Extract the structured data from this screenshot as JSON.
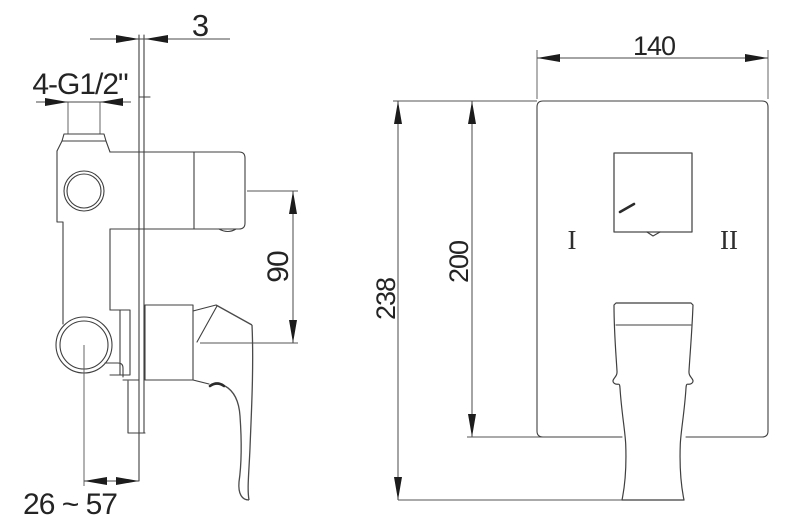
{
  "colors": {
    "background": "#ffffff",
    "line": "#3f3f3f",
    "dimension_line": "#4a4a4a",
    "arrow": "#1c1c1c",
    "text": "#242424"
  },
  "side_view": {
    "dims": {
      "wall_plate_thickness": "3",
      "inlet_thread": "4-G1/2\"",
      "spout_to_handle_distance": "90",
      "installation_depth_range": "26 ~ 57"
    }
  },
  "front_view": {
    "dims": {
      "plate_width": "140",
      "overall_height": "238",
      "plate_height": "200"
    },
    "labels": {
      "position_one": "I",
      "position_two": "II"
    }
  }
}
